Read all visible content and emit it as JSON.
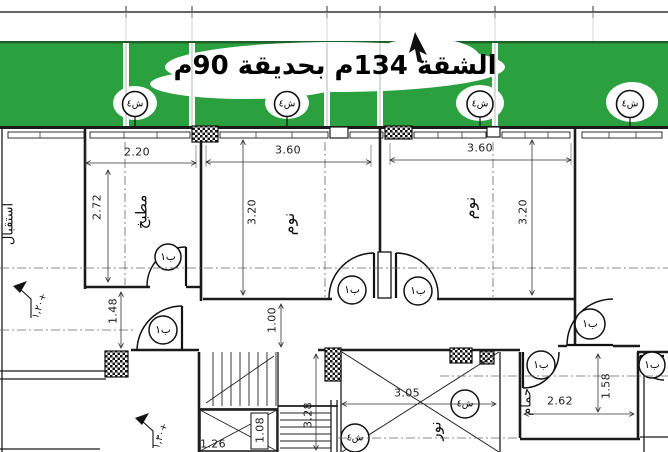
{
  "title": "الشقة 134م بحديقة 90م",
  "colors": {
    "garden": "#2ba03e",
    "ink": "#1b1b1b"
  },
  "rooms": {
    "reception": "استقبال",
    "kitchen": "مطبخ",
    "bedroom1": "نوم",
    "bedroom2": "نوم",
    "bathroom": "حمام",
    "lightwell": "نور"
  },
  "dimensions": {
    "kitchen_width": "2.20",
    "kitchen_depth": "2.72",
    "bedroom1_width": "3.60",
    "bedroom1_depth": "3.20",
    "bedroom2_width": "3.60",
    "bedroom2_depth": "3.20",
    "hall_width": "1.48",
    "corridor_width": "1.00",
    "lightwell_width": "3.05",
    "lightwell_depth": "3.28",
    "bathroom_width": "2.62",
    "bathroom_depth": "1.58",
    "shaft_width": "1.08",
    "stair_width": "1.26"
  },
  "levels": {
    "reception": "١,٢٠+",
    "stair": "١,٣٠+"
  },
  "tags": {
    "window": "ش٤",
    "door": "ب١"
  }
}
